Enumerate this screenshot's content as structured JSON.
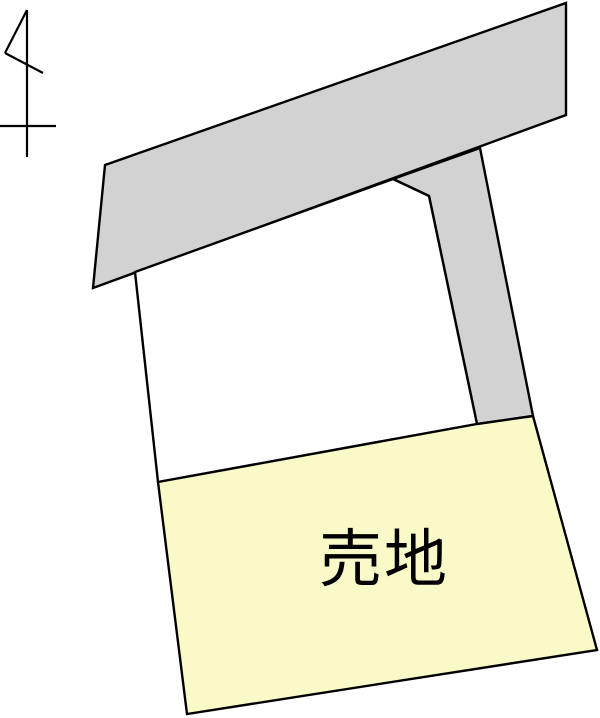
{
  "site_plan": {
    "sale_plot_label": "売地",
    "north_symbol": "north-arrow",
    "colors": {
      "background": "#ffffff",
      "road_fill": "#d2d2d2",
      "adjacent_plot_fill": "#ffffff",
      "sale_plot_fill": "#fafac8",
      "outline": "#000000",
      "label_text": "#000000"
    }
  }
}
